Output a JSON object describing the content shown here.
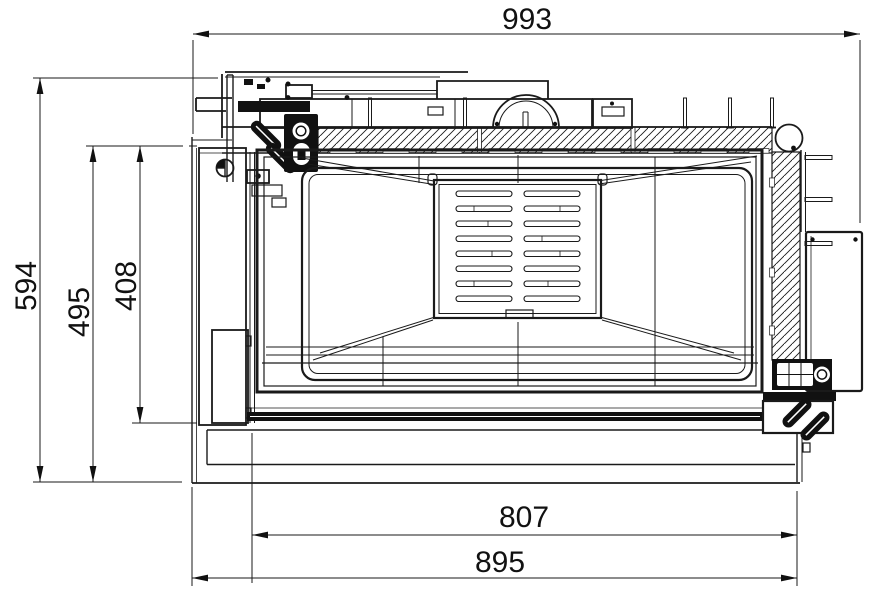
{
  "drawing": {
    "background": "#ffffff",
    "line_color": "#1a1a1a",
    "dimensions": {
      "total_width": "993",
      "total_height": "594",
      "frame_height": "495",
      "opening_height": "408",
      "opening_width": "807",
      "base_width": "895"
    }
  }
}
